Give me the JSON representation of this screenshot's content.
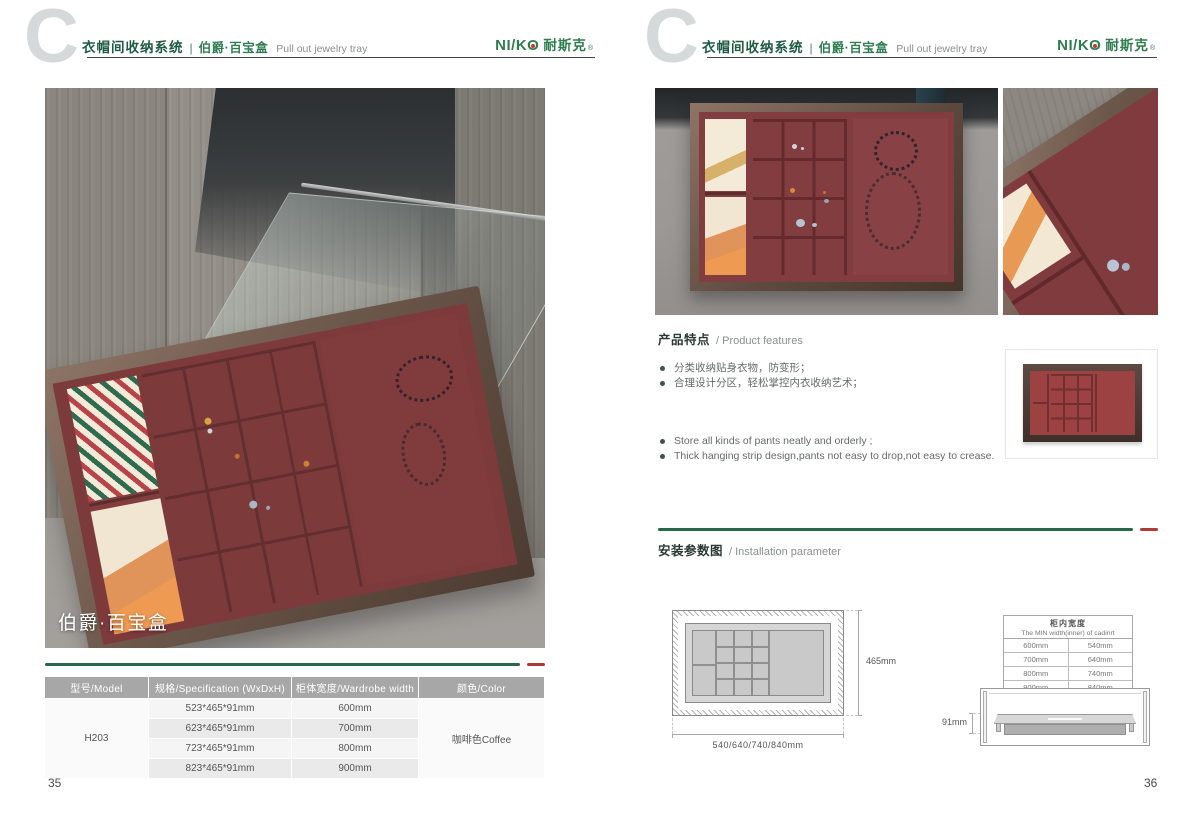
{
  "header": {
    "c_glyph": "C",
    "category": "衣帽间收纳系统",
    "divider": "|",
    "series": "伯爵·百宝盒",
    "subtitle": "Pull out jewelry tray",
    "brand": {
      "latin_left": "NI/K",
      "latin_o": "O",
      "cjk": "耐斯克",
      "mark": "®"
    }
  },
  "left_page": {
    "page_number": "35",
    "photo_caption": "伯爵·百宝盒",
    "spec_table": {
      "headers": [
        "型号/Model",
        "规格/Specification (WxDxH)",
        "柜体宽度/Wardrobe width",
        "颜色/Color"
      ],
      "model": "H203",
      "rows": [
        {
          "spec": "523*465*91mm",
          "width": "600mm"
        },
        {
          "spec": "623*465*91mm",
          "width": "700mm"
        },
        {
          "spec": "723*465*91mm",
          "width": "800mm"
        },
        {
          "spec": "823*465*91mm",
          "width": "900mm"
        }
      ],
      "color": "咖啡色Coffee"
    }
  },
  "right_page": {
    "page_number": "36",
    "features": {
      "title_zh": "产品特点",
      "title_en": "/ Product features",
      "bullets_zh": [
        "分类收纳贴身衣物，防变形；",
        "合理设计分区，轻松掌控内衣收纳艺术；"
      ],
      "bullets_en": [
        "Store all kinds of pants neatly and orderly ;",
        "Thick hanging strip design,pants not easy to drop,not easy to crease."
      ]
    },
    "installation": {
      "title_zh": "安装参数图",
      "title_en": "/ Installation parameter",
      "top_view": {
        "depth_label": "465mm",
        "width_label": "540/640/740/840mm"
      },
      "width_table": {
        "title_zh": "柜内宽度",
        "title_en": "The MIN width(inner) of cadinrt",
        "rows": [
          {
            "wardrobe": "600mm",
            "inner": "540mm"
          },
          {
            "wardrobe": "700mm",
            "inner": "640mm"
          },
          {
            "wardrobe": "800mm",
            "inner": "740mm"
          },
          {
            "wardrobe": "900mm",
            "inner": "840mm"
          }
        ]
      },
      "side_view": {
        "height_label": "91mm"
      }
    }
  },
  "colors": {
    "heading_green": "#1e5c42",
    "brand_green": "#2e7d4e",
    "separator_green": "#25694a",
    "accent_red": "#b03a38",
    "table_header_gray": "#a7a7a7",
    "tray_red": "#7d3a3b"
  }
}
